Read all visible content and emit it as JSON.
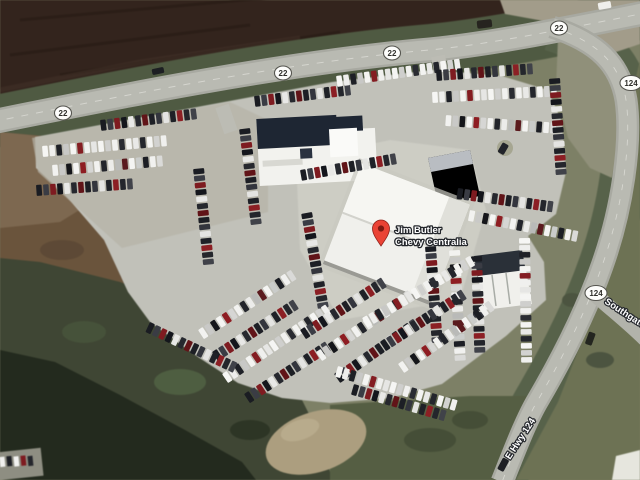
{
  "map": {
    "pin": {
      "name_line1": "Jim Butler",
      "name_line2": "Chevy Centralia",
      "color": "#ea4335"
    },
    "shields": {
      "route_22": "22",
      "route_124": "124"
    },
    "road_labels": {
      "southgate": "Southgate",
      "e_hwy_124": "E Hwy 124"
    },
    "palette": {
      "road": "#b6b7af",
      "pavement": "#c1c1b9",
      "plowed_field": "#33241d",
      "grass": "#4f5a42",
      "trees": "#232a1e",
      "building_roof_white": "#f0f0ec",
      "building_roof_dark": "#1e2633"
    }
  }
}
